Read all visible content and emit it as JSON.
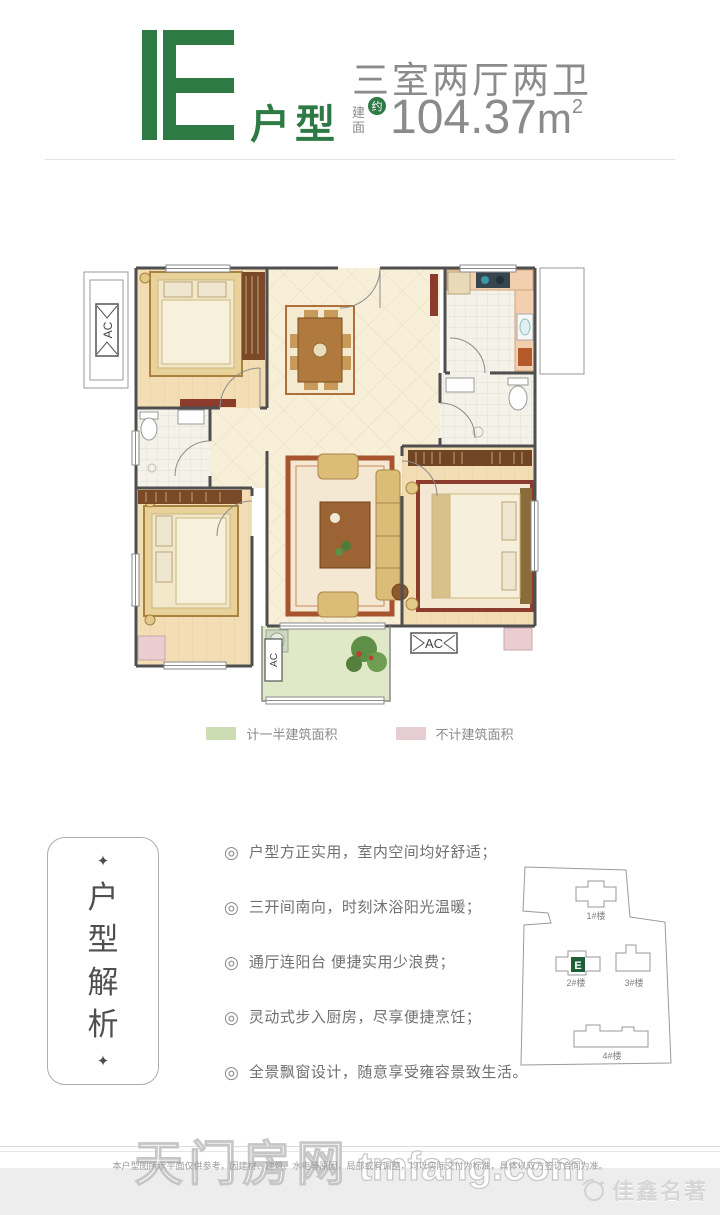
{
  "header": {
    "unit_letter": "E",
    "unit_label": "户型",
    "layout_title": "三室两厅两卫",
    "area_label_line1": "建",
    "area_label_line2": "面",
    "area_approx_badge": "约",
    "area_value": "104.37",
    "area_unit": "m",
    "area_superscript": "2",
    "accent_green": "#2e7a45",
    "text_gray": "#8b8b8b"
  },
  "floorplan": {
    "ac_label_left": "AC",
    "ac_label_balcony": "AC",
    "ac_label_bottom": "AC"
  },
  "legend": {
    "items": [
      {
        "label": "计一半建筑面积",
        "color": "#ccddb4"
      },
      {
        "label": "不计建筑面积",
        "color": "#e6cdd1"
      }
    ]
  },
  "analysis": {
    "decor_diamond": "✦",
    "panel_chars": [
      "户",
      "型",
      "解",
      "析"
    ],
    "bullet_icon": "◎",
    "bullets": [
      "户型方正实用，室内空间均好舒适；",
      "三开间南向，时刻沐浴阳光温暖；",
      "通厅连阳台 便捷实用少浪费；",
      "灵动式步入厨房，尽享便捷烹饪；",
      "全景飘窗设计，随意享受雍容景致生活。"
    ]
  },
  "sitemap": {
    "marker_letter": "E",
    "marker_color": "#1f5e38",
    "buildings": [
      {
        "label": "1#楼"
      },
      {
        "label": "2#楼"
      },
      {
        "label": "3#楼"
      },
      {
        "label": "4#楼"
      }
    ]
  },
  "footer": {
    "watermark_cn": "天门房网",
    "watermark_en": "tmfang.com",
    "disclaimer": "本户型图所示平面仅供参考，因建材、建筑、水电等原因，局部或有调整，均以实际交付为标准，具体以双方签订合同为准。",
    "brand": "佳鑫名著"
  }
}
